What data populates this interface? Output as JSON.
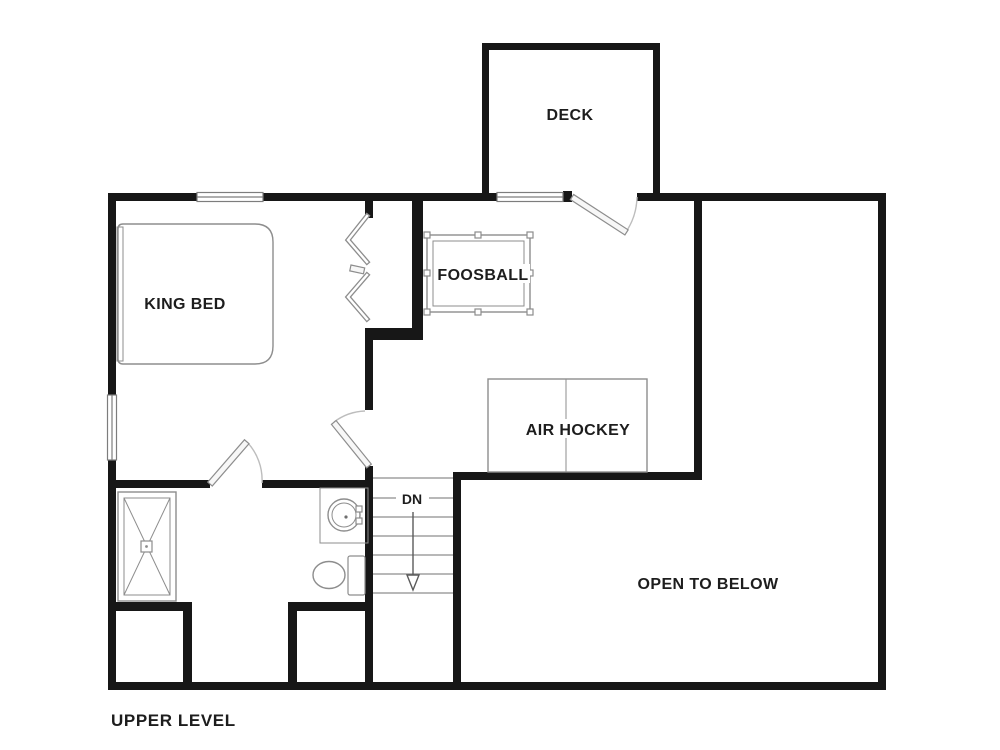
{
  "title": "UPPER LEVEL",
  "plan_type": "floor-plan",
  "labels": {
    "deck": "DECK",
    "king_bed": "KING BED",
    "foosball": "FOOSBALL",
    "air_hockey": "AIR HOCKEY",
    "down": "DN",
    "open_to_below": "OPEN TO BELOW",
    "upper_level": "UPPER LEVEL"
  },
  "colors": {
    "bg": "#ffffff",
    "wall": "#171717",
    "line": "#7d7d7d",
    "fixture": "#8d8d8d",
    "arc": "#bdbdbd",
    "text": "#1d1d1d"
  }
}
